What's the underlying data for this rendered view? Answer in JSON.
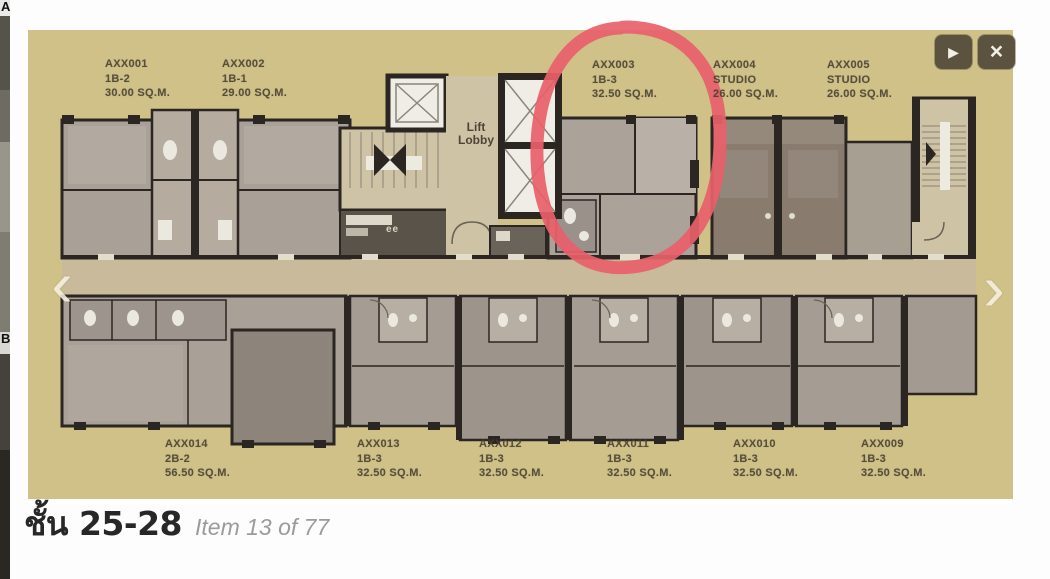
{
  "gallery": {
    "prev_icon": "‹",
    "next_icon": "›",
    "play_icon": "▶",
    "close_icon": "×"
  },
  "background_page": {
    "letter_top": "A",
    "letter_mid": "B"
  },
  "plan": {
    "lift_lobby": {
      "line1": "Lift",
      "line2": "Lobby"
    },
    "ee_label": "ee",
    "highlight_color": "#e8606a",
    "highlighted_unit": "AXX003",
    "units_top": [
      {
        "id": "AXX001",
        "type": "1B-2",
        "area": "30.00 SQ.M."
      },
      {
        "id": "AXX002",
        "type": "1B-1",
        "area": "29.00 SQ.M."
      },
      {
        "id": "AXX003",
        "type": "1B-3",
        "area": "32.50 SQ.M."
      },
      {
        "id": "AXX004",
        "type": "STUDIO",
        "area": "26.00 SQ.M."
      },
      {
        "id": "AXX005",
        "type": "STUDIO",
        "area": "26.00 SQ.M."
      }
    ],
    "units_bottom": [
      {
        "id": "AXX014",
        "type": "2B-2",
        "area": "56.50 SQ.M."
      },
      {
        "id": "AXX013",
        "type": "1B-3",
        "area": "32.50 SQ.M."
      },
      {
        "id": "AXX012",
        "type": "1B-3",
        "area": "32.50 SQ.M."
      },
      {
        "id": "AXX011",
        "type": "1B-3",
        "area": "32.50 SQ.M."
      },
      {
        "id": "AXX010",
        "type": "1B-3",
        "area": "32.50 SQ.M."
      },
      {
        "id": "AXX009",
        "type": "1B-3",
        "area": "32.50 SQ.M."
      }
    ]
  },
  "caption": {
    "floor": "ชั้น 25-28",
    "item": "Item 13 of 77",
    "current_item": 13,
    "total_items": 77
  },
  "colors": {
    "plan_background": "#cfc188",
    "annotation_red": "#e8606a",
    "button_background": "#5b5340"
  }
}
